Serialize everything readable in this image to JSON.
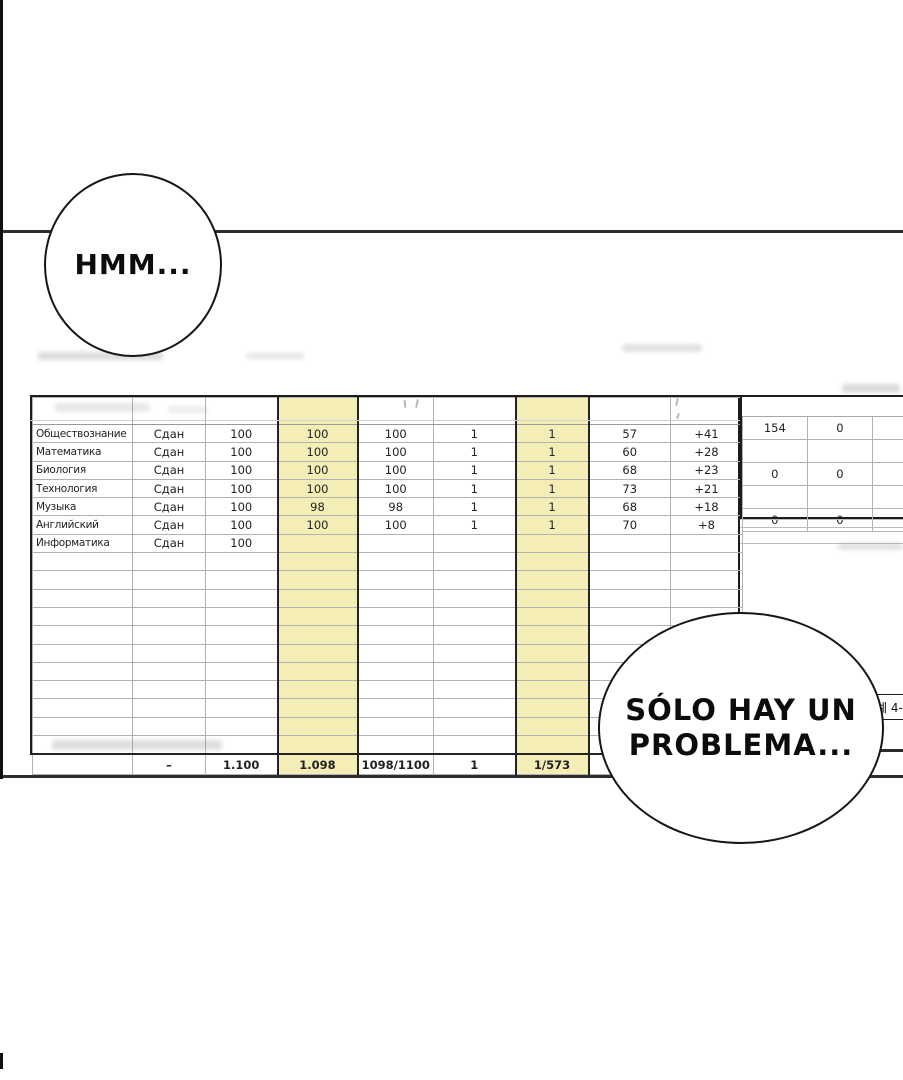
{
  "bubbles": {
    "hmm": {
      "text": "HMM..."
    },
    "problema": {
      "line1": "SÓLO HAY UN",
      "line2": "PROBLEMA..."
    }
  },
  "side_note": {
    "text": "예 4-"
  },
  "grade_sheet": {
    "highlight_color": "#f4eeb6",
    "rows": [
      {
        "cells": [
          "Обществознание",
          "Сдан",
          "100",
          "100",
          "100",
          "1",
          "1",
          "57",
          "+41"
        ]
      },
      {
        "cells": [
          "Математика",
          "Сдан",
          "100",
          "100",
          "100",
          "1",
          "1",
          "60",
          "+28"
        ]
      },
      {
        "cells": [
          "Биология",
          "Сдан",
          "100",
          "100",
          "100",
          "1",
          "1",
          "68",
          "+23"
        ]
      },
      {
        "cells": [
          "Технология",
          "Сдан",
          "100",
          "100",
          "100",
          "1",
          "1",
          "73",
          "+21"
        ]
      },
      {
        "cells": [
          "Музыка",
          "Сдан",
          "100",
          "98",
          "98",
          "1",
          "1",
          "68",
          "+18"
        ]
      },
      {
        "cells": [
          "Английский",
          "Сдан",
          "100",
          "100",
          "100",
          "1",
          "1",
          "70",
          "+8"
        ]
      },
      {
        "cells": [
          "Информатика",
          "Сдан",
          "100",
          "",
          "",
          "",
          "",
          "",
          ""
        ]
      }
    ],
    "empty_row_count": 11,
    "totals": {
      "cells": [
        "",
        "–",
        "1.100",
        "1.098",
        "1098/1100",
        "1",
        "1/573",
        "",
        ""
      ]
    }
  },
  "summary_sheet": {
    "rows": [
      [
        "154",
        "0",
        "0"
      ],
      [
        "",
        "",
        ""
      ],
      [
        "0",
        "0",
        "0"
      ],
      [
        "",
        "",
        ""
      ],
      [
        "0",
        "0",
        "0"
      ]
    ]
  }
}
